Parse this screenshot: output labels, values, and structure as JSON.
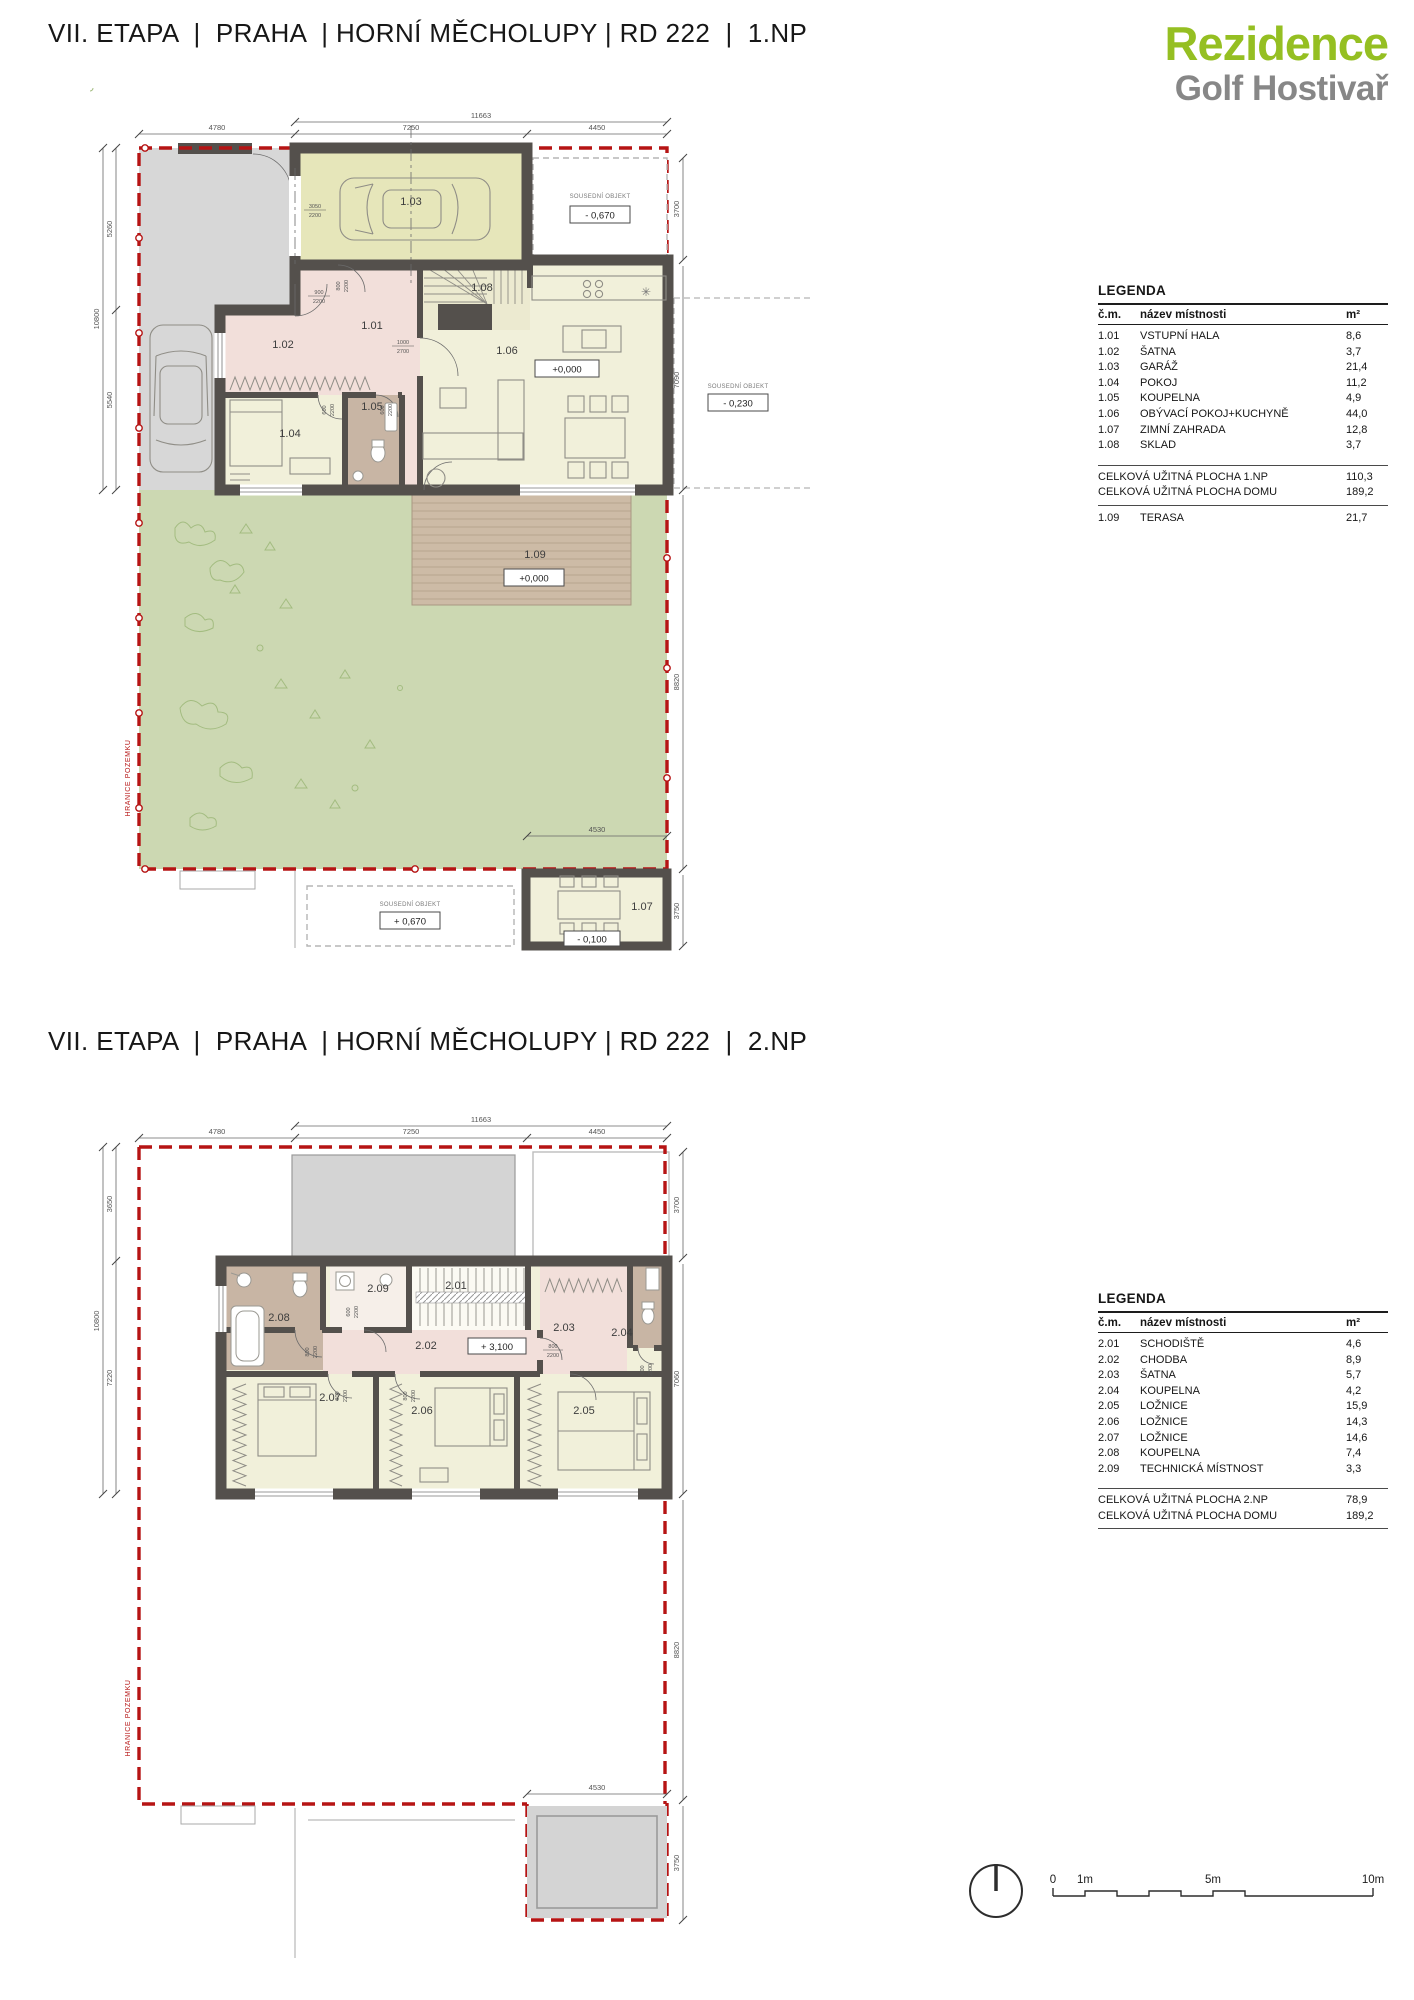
{
  "header": {
    "title_1np": "VII. ETAPA  |  PRAHA  | HORNÍ MĚCHOLUPY | RD 222  |  1.NP",
    "title_2np": "VII. ETAPA  |  PRAHA  | HORNÍ MĚCHOLUPY | RD 222  |  2.NP"
  },
  "logo": {
    "name": "Rezidence",
    "subtitle": "Golf Hostivař",
    "green": "#95bf22",
    "gray": "#878787"
  },
  "colors": {
    "boundary_red": "#b61414",
    "wall": "#54504c",
    "garden_green": "#ccd8b2",
    "terrace_tan": "#cdbba6",
    "garage_olive": "#e6e6ba",
    "room_cream": "#f1f0da",
    "hall_pink": "#f2dfda",
    "bath_brown": "#c8b5a4",
    "paving_gray": "#d7d7d7"
  },
  "legend1": {
    "title": "LEGENDA",
    "columns": [
      "č.m.",
      "název místnosti",
      "m²"
    ],
    "rows": [
      [
        "1.01",
        "VSTUPNÍ HALA",
        "8,6"
      ],
      [
        "1.02",
        "ŠATNA",
        "3,7"
      ],
      [
        "1.03",
        "GARÁŽ",
        "21,4"
      ],
      [
        "1.04",
        "POKOJ",
        "11,2"
      ],
      [
        "1.05",
        "KOUPELNA",
        "4,9"
      ],
      [
        "1.06",
        "OBÝVACÍ POKOJ+KUCHYNĚ",
        "44,0"
      ],
      [
        "1.07",
        "ZIMNÍ ZAHRADA",
        "12,8"
      ],
      [
        "1.08",
        "SKLAD",
        "3,7"
      ]
    ],
    "totals": [
      [
        "CELKOVÁ UŽITNÁ PLOCHA 1.NP",
        "110,3"
      ],
      [
        "CELKOVÁ UŽITNÁ PLOCHA DOMU",
        "189,2"
      ]
    ],
    "extra": [
      "1.09",
      "TERASA",
      "21,7"
    ]
  },
  "legend2": {
    "title": "LEGENDA",
    "columns": [
      "č.m.",
      "název místnosti",
      "m²"
    ],
    "rows": [
      [
        "2.01",
        "SCHODIŠTĚ",
        "4,6"
      ],
      [
        "2.02",
        "CHODBA",
        "8,9"
      ],
      [
        "2.03",
        "ŠATNA",
        "5,7"
      ],
      [
        "2.04",
        "KOUPELNA",
        "4,2"
      ],
      [
        "2.05",
        "LOŽNICE",
        "15,9"
      ],
      [
        "2.06",
        "LOŽNICE",
        "14,3"
      ],
      [
        "2.07",
        "LOŽNICE",
        "14,6"
      ],
      [
        "2.08",
        "KOUPELNA",
        "7,4"
      ],
      [
        "2.09",
        "TECHNICKÁ MÍSTNOST",
        "3,3"
      ]
    ],
    "totals": [
      [
        "CELKOVÁ UŽITNÁ PLOCHA 2.NP",
        "78,9"
      ],
      [
        "CELKOVÁ UŽITNÁ PLOCHA DOMU",
        "189,2"
      ]
    ]
  },
  "plan1": {
    "rooms": {
      "r101": "1.01",
      "r102": "1.02",
      "r103": "1.03",
      "r104": "1.04",
      "r105": "1.05",
      "r106": "1.06",
      "r107": "1.07",
      "r108": "1.08",
      "r109": "1.09"
    },
    "dims": {
      "tt": "11663",
      "t1": "4780",
      "t2": "7250",
      "t3": "4450",
      "l0": "10800",
      "l1": "5260",
      "l2": "5540",
      "r1": "3700",
      "r2": "7090",
      "r3": "8820",
      "r4": "3750",
      "b1": "4530"
    },
    "doors": {
      "a1": "3050",
      "a2": "2200",
      "b1": "900",
      "b2": "2200",
      "c1": "1000",
      "c2": "2700",
      "d1": "800",
      "d2": "2200",
      "e1": "600",
      "e2": "2200"
    },
    "elev": {
      "garage_neighbor": "- 0,670",
      "right_neighbor": "- 0,230",
      "bottom_neighbor": "+ 0,670",
      "living": "+0,000",
      "terrace": "+0,000",
      "winter_garden": "- 0,100"
    },
    "neighbor_label": "SOUSEDNÍ OBJEKT",
    "boundary_label": "HRANICE POZEMKU",
    "icons": {
      "appliance": "✳"
    }
  },
  "plan2": {
    "rooms": {
      "r201": "2.01",
      "r202": "2.02",
      "r203": "2.03",
      "r204": "2.04",
      "r205": "2.05",
      "r206": "2.06",
      "r207": "2.07",
      "r208": "2.08",
      "r209": "2.09"
    },
    "dims": {
      "tt": "11663",
      "t1": "4780",
      "t2": "7250",
      "t3": "4450",
      "l0": "10800",
      "l1": "3650",
      "l2": "7220",
      "r1": "3700",
      "r2": "7060",
      "r3": "8820",
      "r4": "3750",
      "b1": "4530"
    },
    "doors": {
      "d1": "800",
      "d2": "2200",
      "e1": "600",
      "e2": "2200"
    },
    "elev": {
      "hall": "+ 3,100"
    },
    "boundary_label": "HRANICE POZEMKU"
  },
  "footer": {
    "scale": {
      "t0": "0",
      "t1": "1m",
      "t5": "5m",
      "t10": "10m"
    }
  }
}
